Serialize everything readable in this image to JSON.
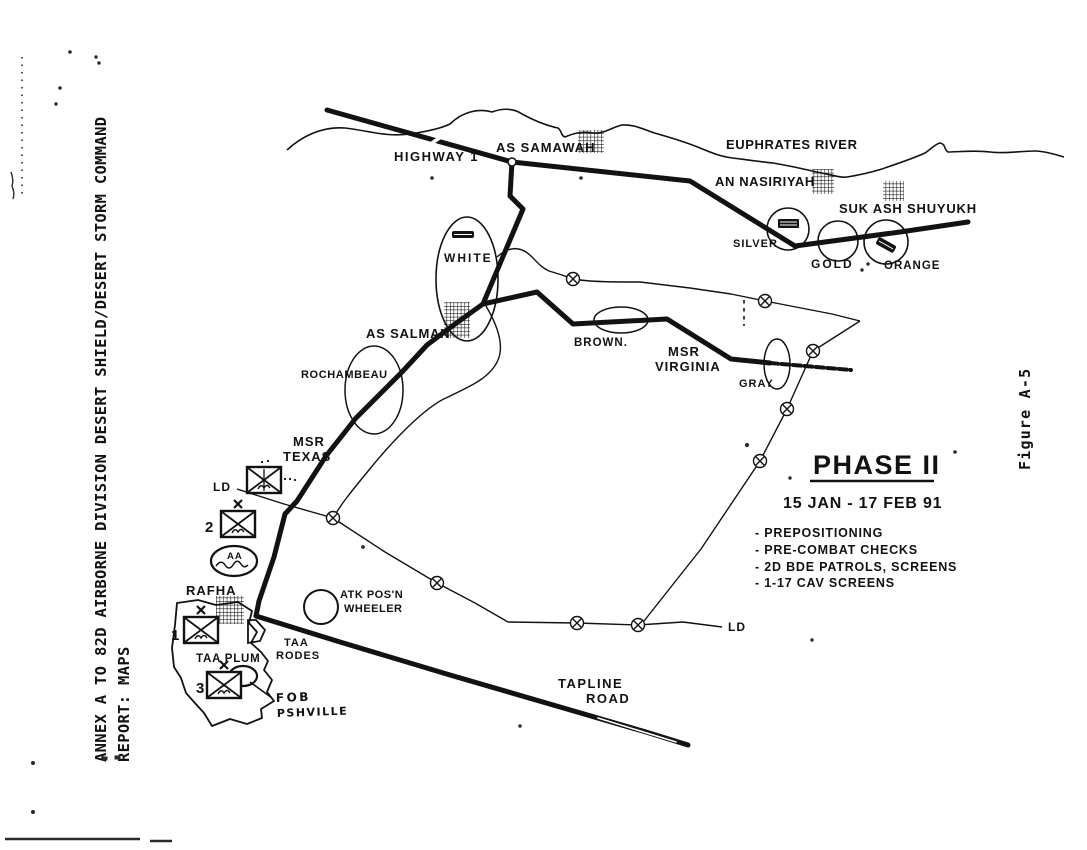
{
  "side_annotation": {
    "line1": "ANNEX A TO 82D AIRBORNE DIVISION DESERT SHIELD/DESERT STORM COMMAND",
    "line2": "REPORT:  MAPS"
  },
  "figure_label": "Figure A-5",
  "phase_panel": {
    "title": "PHASE II",
    "date_range": "15 JAN - 17 FEB 91",
    "bullets": [
      "- PREPOSITIONING",
      "- PRE-COMBAT CHECKS",
      "- 2D BDE PATROLS, SCREENS",
      "- 1-17 CAV SCREENS"
    ]
  },
  "map": {
    "roads": {
      "highway1": "HIGHWAY 1",
      "msr_texas_line1": "MSR",
      "msr_texas_line2": "TEXAS",
      "msr_virginia_line1": "MSR",
      "msr_virginia_line2": "VIRGINIA",
      "tapline_road_line1": "TAPLINE",
      "tapline_road_line2": "ROAD"
    },
    "water": {
      "euphrates_river": "EUPHRATES RIVER"
    },
    "towns": {
      "as_samawah": "AS SAMAWAH",
      "an_nasiriyah": "AN NASIRIYAH",
      "suk_ash_shuyukh": "SUK ASH SHUYUKH",
      "as_salman": "AS SALMAN",
      "rafha": "RAFHA"
    },
    "objectives": {
      "white": "WHITE",
      "silver": "SILVER",
      "gold": "GOLD",
      "orange": "ORANGE",
      "brown": "BROWN.",
      "gray": "GRAY",
      "rochambeau": "ROCHAMBEAU"
    },
    "control_measures": {
      "ld_west": "LD",
      "ld_east": "LD",
      "atk_posn_line1": "ATK POS'N",
      "atk_posn_line2": "WHEELER",
      "taa_plum": "TAA PLUM",
      "taa_rodes_line1": "TAA",
      "taa_rodes_line2": "RODES",
      "assembly_area": "AA",
      "fob_line1": "FOB",
      "fob_line2": "PSHVILLE"
    },
    "unit_numbers": {
      "brigade_1": "1",
      "brigade_2": "2",
      "brigade_3": "3"
    }
  },
  "symbols": {
    "checkpoint_marker": "circled-x",
    "town_marker": "crosshatched-square",
    "airstrip_marker": "black-bar",
    "unit_marker": "infantry-box-with-x"
  },
  "colors": {
    "ink": "#121212",
    "paper": "#ffffff"
  }
}
